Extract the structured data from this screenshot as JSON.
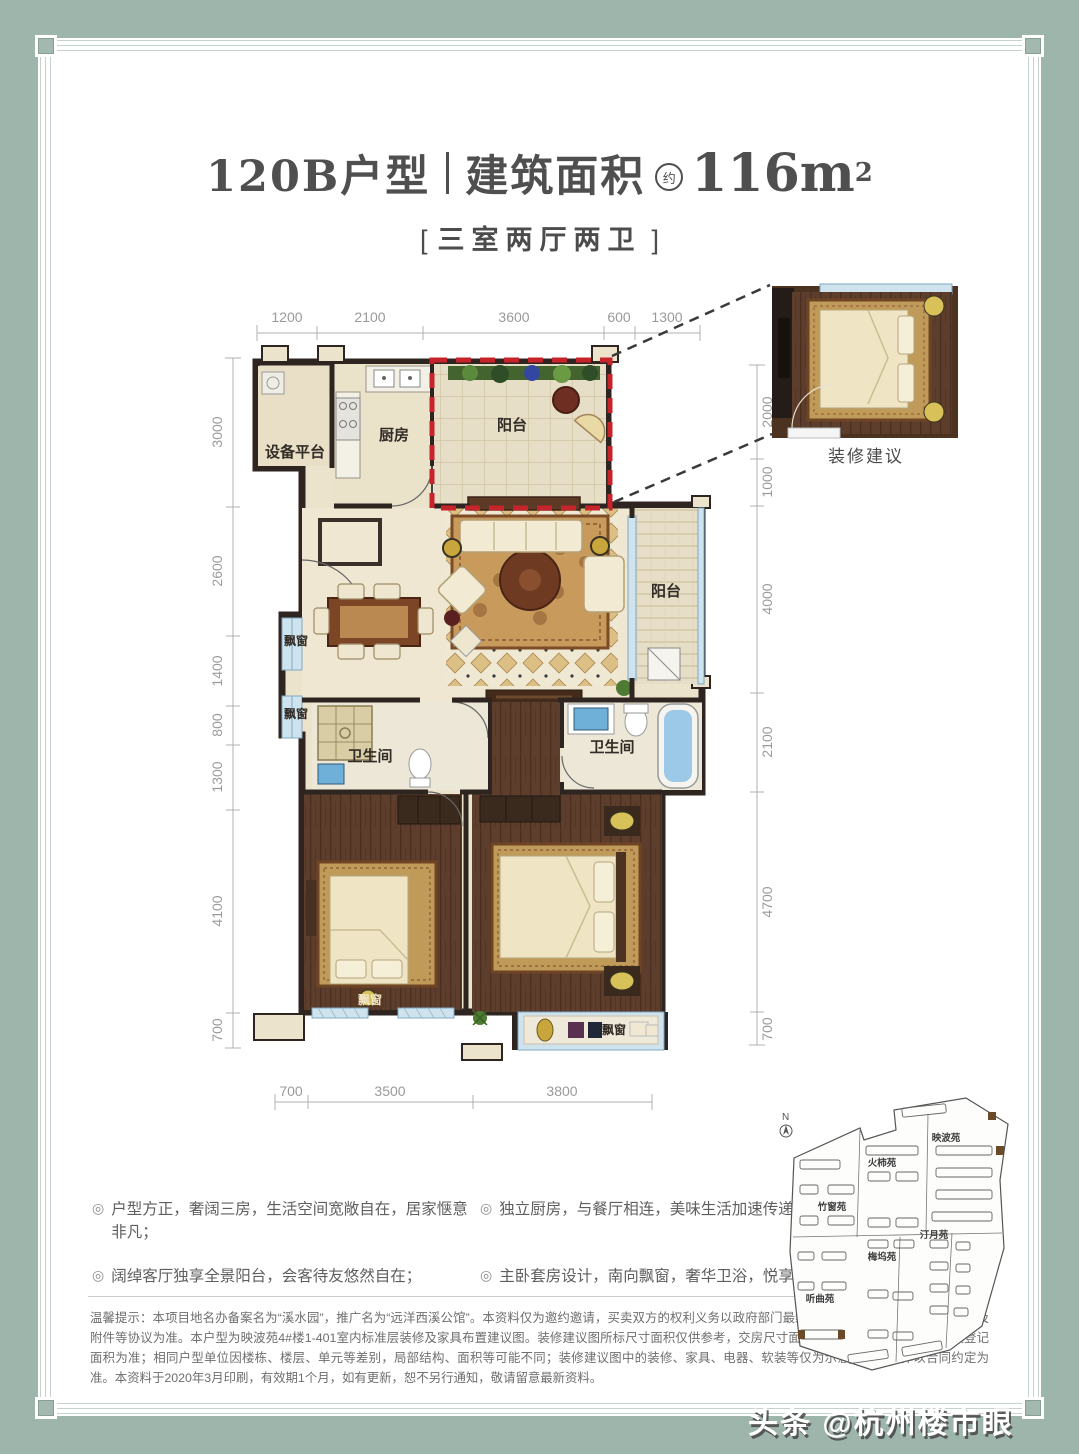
{
  "header": {
    "type_name": "120B户型",
    "area_label": "建筑面积",
    "area_approx": "约",
    "area_value": "116m",
    "area_sup": "2",
    "bracket_left": "[",
    "bracket_right": "]",
    "subtitle": "三室两厅两卫"
  },
  "dimensions": {
    "top": [
      "1200",
      "2100",
      "3600",
      "600",
      "1300"
    ],
    "left": [
      "3000",
      "2600",
      "1400",
      "800",
      "1300",
      "4100",
      "700"
    ],
    "right": [
      "2000",
      "1000",
      "4000",
      "2100",
      "4700",
      "700"
    ],
    "bottom": [
      "700",
      "3500",
      "3800"
    ]
  },
  "plan": {
    "rooms": {
      "equipment_platform": "设备平台",
      "kitchen": "厨房",
      "balcony_top": "阳台",
      "balcony_right": "阳台",
      "bay_window_1": "飘窗",
      "bay_window_2": "飘窗",
      "bathroom_left": "卫生间",
      "bathroom_right": "卫生间",
      "bay_window_bottom_left": "飘窗",
      "bay_window_bottom": "飘窗"
    },
    "inset_caption": "装修建议"
  },
  "features": {
    "marker": "◎",
    "items": [
      "户型方正，奢阔三房，生活空间宽敞自在，居家惬意非凡；",
      "独立厨房，与餐厅相连，美味生活加速传递；",
      "阔绰客厅独享全景阳台，会客待友悠然自在；",
      "主卧套房设计，南向飘窗，奢华卫浴，悦享尊荣人生。"
    ]
  },
  "disclaimer": "温馨提示：本项目地名办备案名为“溪水园”，推广名为“远洋西溪公馆”。本资料仅为邀约邀请，买卖双方的权利义务以政府部门最终批准文件、《商品房买卖合同》及附件等协议为准。本户型为映波苑4#楼1-401室内标准层装修及家具布置建议图。装修建议图所标尺寸面积仅供参考，交房尺寸面积根据合同约定并最终以产权登记面积为准；相同户型单位因楼栋、楼层、单元等差别，局部结构、面积等可能不同；装修建议图中的装修、家具、电器、软装等仅为示意参考，具体以合同约定为准。本资料于2020年3月印刷，有效期1个月，如有更新，恕不另行通知，敬请留意最新资料。",
  "siteplan": {
    "north_label": "N",
    "districts": [
      "映波苑",
      "火柿苑",
      "竹窗苑",
      "汀月苑",
      "梅坞苑",
      "听曲苑"
    ]
  },
  "watermark": {
    "text": "头条 @杭州楼市眼"
  },
  "colors": {
    "frame_green": "#9eb5ac",
    "red_dashed_outline": "#c7232b",
    "wall_dark": "#2e2520",
    "wood_floor": "#5d3d2b",
    "window_blue": "#cfe3ef",
    "floor_cream": "#ece3cd",
    "rug_gold": "#c89a5c"
  }
}
